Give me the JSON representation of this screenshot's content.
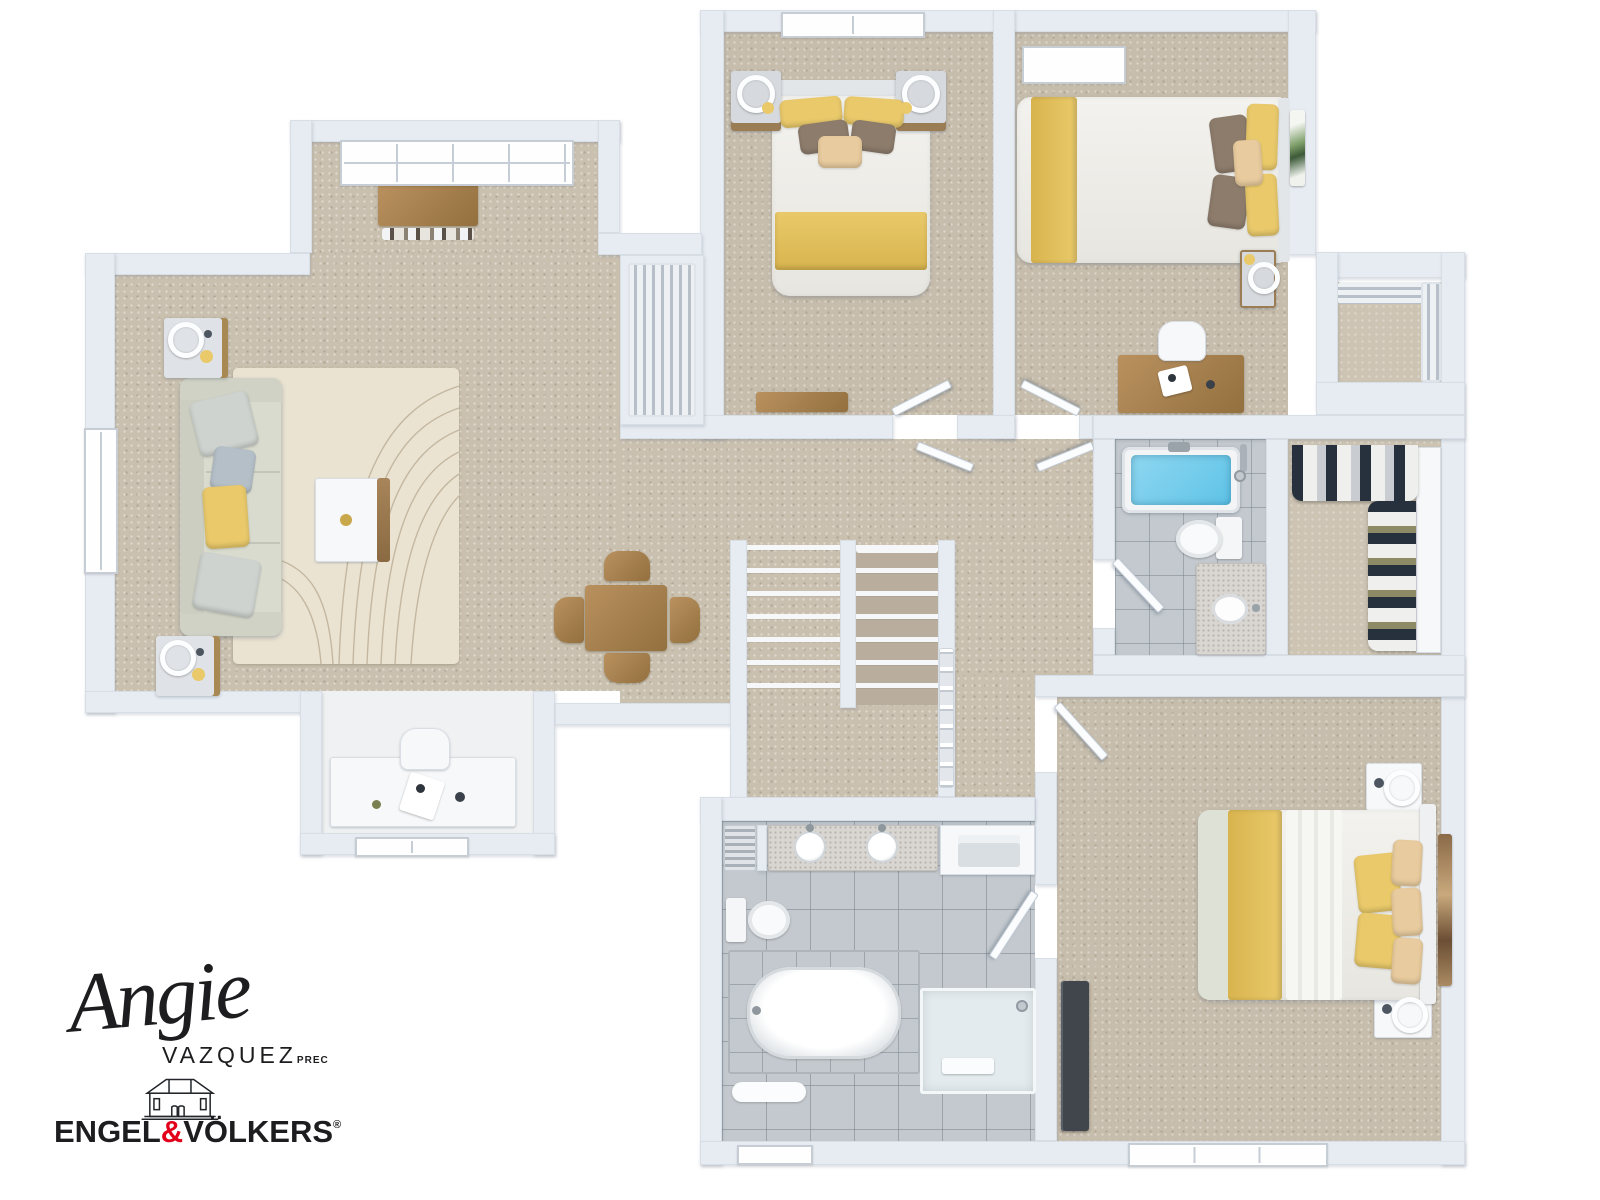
{
  "branding": {
    "agent_first_name": "Angie",
    "agent_last_name": "VAZQUEZ",
    "agent_designation": "PREC",
    "brokerage_word_left": "ENGEL",
    "brokerage_ampersand": "&",
    "brokerage_word_right": "VÖLKERS",
    "registered_mark": "®"
  },
  "palette": {
    "page-bg": "#ffffff",
    "wall": "#e7ecf2",
    "carpet": "#cac0af",
    "room-carpet": "#c7bdac",
    "closet-carpet": "#cdc4b3",
    "rug": "#eae3d2",
    "rug-line": "#ab9a7f",
    "wood": "#b9915f",
    "wood-dark": "#93703f",
    "furn-white": "#f7f8f9",
    "duvet": "#f3f2ee",
    "accent-yellow": "#e9c96a",
    "pillow-brown": "#8d7c6c",
    "pillow-tan": "#e8cb9e",
    "sofa": "#d9dbce",
    "pillow-gray": "#ced3cf",
    "pillow-blue": "#b4bfc8",
    "tile": "#c3c9ce",
    "tub-water": "#5fc3e7",
    "glass": "#e4ebee",
    "dresser-dark": "#41464d",
    "cloth-dark": "#27303d",
    "cloth-light": "#eff0ee",
    "nook-floor": "#eff1f2",
    "ink": "#1d1d1f",
    "brand-red": "#e2001a"
  },
  "floor_plan": {
    "view": "3d-top-down-render",
    "rooms": [
      {
        "id": "living-room",
        "furniture": [
          "sofa",
          "throw-pillows",
          "end-table-with-ring-lamp",
          "end-table-with-ring-lamp",
          "coffee-table",
          "area-rug",
          "window"
        ]
      },
      {
        "id": "entry-alcove",
        "furniture": [
          "window",
          "wood-sideboard",
          "books"
        ]
      },
      {
        "id": "dining-area",
        "furniture": [
          "square-wood-table",
          "four-wood-chairs"
        ]
      },
      {
        "id": "hallway-landing",
        "furniture": [
          "staircase-two-flights",
          "railing",
          "linen-shelves"
        ]
      },
      {
        "id": "office-nook",
        "furniture": [
          "white-desk",
          "white-chair",
          "window"
        ]
      },
      {
        "id": "bedroom-1",
        "furniture": [
          "double-bed-yellow-white",
          "nightstand-with-ring-lamp",
          "nightstand-with-ring-lamp",
          "headboard-window",
          "wood-bench",
          "door"
        ]
      },
      {
        "id": "bedroom-2",
        "furniture": [
          "double-bed-yellow-white",
          "skylight",
          "nightstand-with-ring-lamp",
          "desk",
          "desk-chair",
          "wall-art",
          "door"
        ]
      },
      {
        "id": "hall-closet-louvered",
        "furniture": [
          "louvered-doors"
        ]
      },
      {
        "id": "linen-closet-top-right",
        "furniture": [
          "louvered-doors"
        ]
      },
      {
        "id": "bathroom",
        "furniture": [
          "bathtub-blue-water",
          "toilet",
          "vanity-sink",
          "door"
        ]
      },
      {
        "id": "walk-in-closet",
        "furniture": [
          "hanging-clothes-rack",
          "hanging-clothes-rack",
          "wardrobe"
        ]
      },
      {
        "id": "master-bedroom",
        "furniture": [
          "double-bed-yellow-white",
          "nightstand-with-ring-lamp",
          "nightstand-with-ring-lamp",
          "dark-dresser",
          "wall-art",
          "window",
          "door"
        ]
      },
      {
        "id": "ensuite-bathroom",
        "furniture": [
          "double-vanity",
          "towel-radiator",
          "toilet",
          "soaker-tub",
          "glass-shower",
          "bath-mat",
          "shelf-niche",
          "window",
          "door"
        ]
      }
    ]
  }
}
